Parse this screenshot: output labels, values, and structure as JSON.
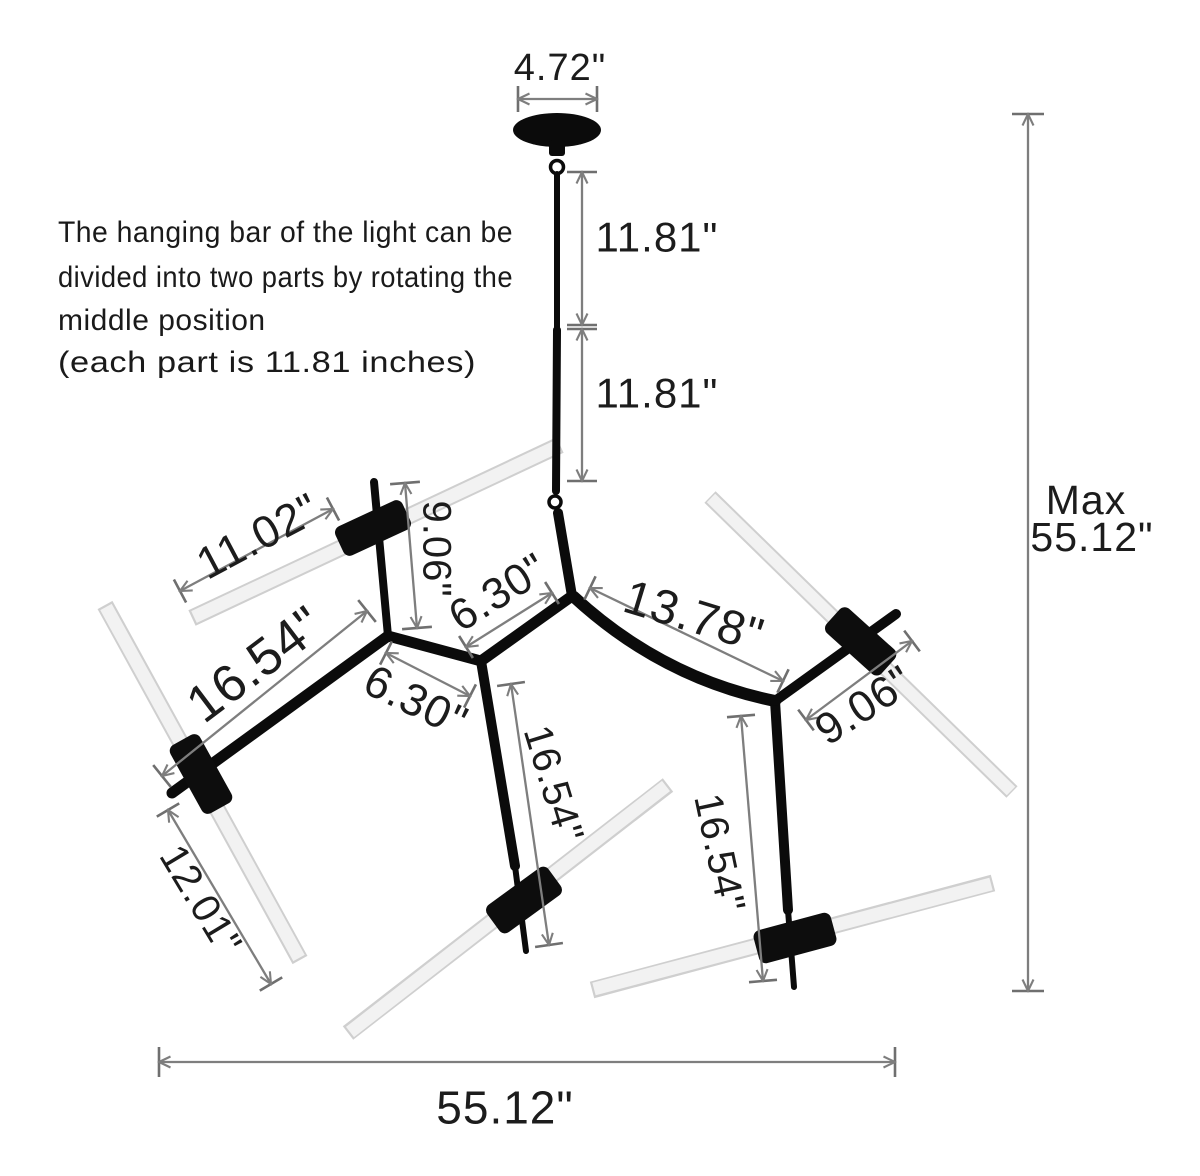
{
  "note": {
    "line1": "The hanging bar of the light can be",
    "line2": "divided into two parts by rotating the",
    "line3": "middle position",
    "line4": "(each part is 11.81 inches)"
  },
  "dimensions": {
    "canopy_width": "4.72\"",
    "hanging_bar_upper": "11.81\"",
    "hanging_bar_lower": "11.81\"",
    "max_height_word": "Max",
    "max_height_value": "55.12\"",
    "tube_upper_left": "11.02\"",
    "stub_upper_left": "9.06\"",
    "branch_top_center": "6.30\"",
    "branch_main": "13.78\"",
    "branch_left": "16.54\"",
    "branch_left_center": "6.30\"",
    "branch_right_upper": "9.06\"",
    "branch_center_drop": "16.54\"",
    "branch_right_drop": "16.54\"",
    "tube_lower_left": "12.01\"",
    "total_width": "55.12\""
  }
}
